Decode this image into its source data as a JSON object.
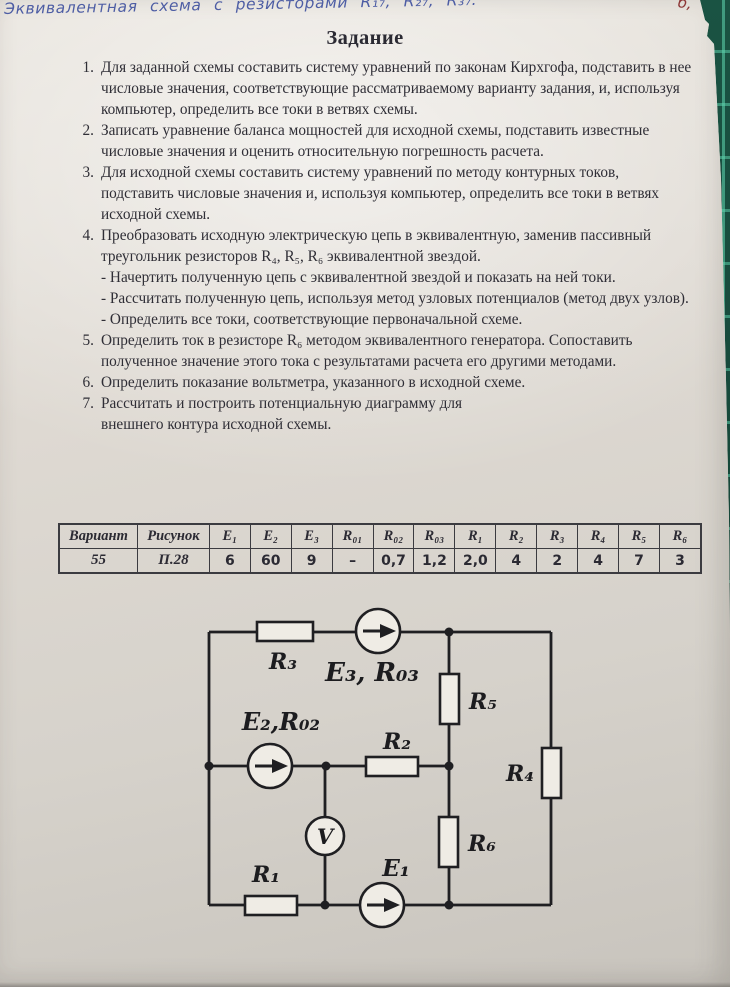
{
  "note": {
    "text": "Эквивалентная схема  с  резисторами R₁₇, R₂₇, R₃₇:",
    "corner_mark": "б,"
  },
  "title": "Задание",
  "tasks": [
    {
      "number": "1.",
      "text": "Для заданной схемы составить систему уравнений по законам Кирхгофа, подставить в нее числовые значения, соответствующие рассматриваемому варианту задания, и, используя компьютер, определить все токи в ветвях схемы."
    },
    {
      "number": "2.",
      "text": "Записать уравнение баланса мощностей для исходной схемы, подставить известные числовые значения и оценить относительную погрешность расчета."
    },
    {
      "number": "3.",
      "text": "Для исходной схемы составить систему уравнений по методу контурных токов, подставить числовые значения и, используя компьютер, определить все токи в ветвях исходной схемы."
    },
    {
      "number": "4.",
      "text": "Преобразовать исходную электрическую цепь в эквивалентную, заменив пассивный треугольник резисторов R₄, R₅, R₆ эквивалентной звездой.",
      "subitems": [
        "- Начертить полученную цепь с эквивалентной звездой и показать на ней токи.",
        "- Рассчитать полученную цепь, используя метод узловых потенциалов (метод двух узлов).",
        "- Определить все токи, соответствующие первоначальной схеме."
      ]
    },
    {
      "number": "5.",
      "text": "Определить ток в резисторе R₆ методом эквивалентного генератора. Сопоставить полученное значение этого тока с результатами расчета его другими методами."
    },
    {
      "number": "6.",
      "text": "Определить показание вольтметра, указанного в исходной схеме."
    },
    {
      "number": "7.",
      "text": "Рассчитать и построить потенциальную диаграмму для",
      "text2": "внешнего контура исходной схемы."
    }
  ],
  "table": {
    "headers": [
      "Вариант",
      "Рисунок",
      "E₁",
      "E₂",
      "E₃",
      "R₀₁",
      "R₀₂",
      "R₀₃",
      "R₁",
      "R₂",
      "R₃",
      "R₄",
      "R₅",
      "R₆"
    ],
    "values": [
      "55",
      "П.28",
      "6",
      "60",
      "9",
      "–",
      "0,7",
      "1,2",
      "2,0",
      "4",
      "2",
      "4",
      "7",
      "3"
    ]
  },
  "circuit": {
    "labels": {
      "r1": "R₁",
      "r2": "R₂",
      "r3": "R₃",
      "r4": "R₄",
      "r5": "R₅",
      "r6": "R₆",
      "e1": "E₁",
      "e2": "E₂,R₀₂",
      "e3": "E₃, R₀₃",
      "v": "V"
    }
  },
  "colors": {
    "paper": "#d9d5ce",
    "ink": "#2f2e36",
    "handwriting": "#4d5da4",
    "mat_green": "#174b3c",
    "mat_grid": "#60d6b0",
    "red_mark": "#8c3636"
  }
}
